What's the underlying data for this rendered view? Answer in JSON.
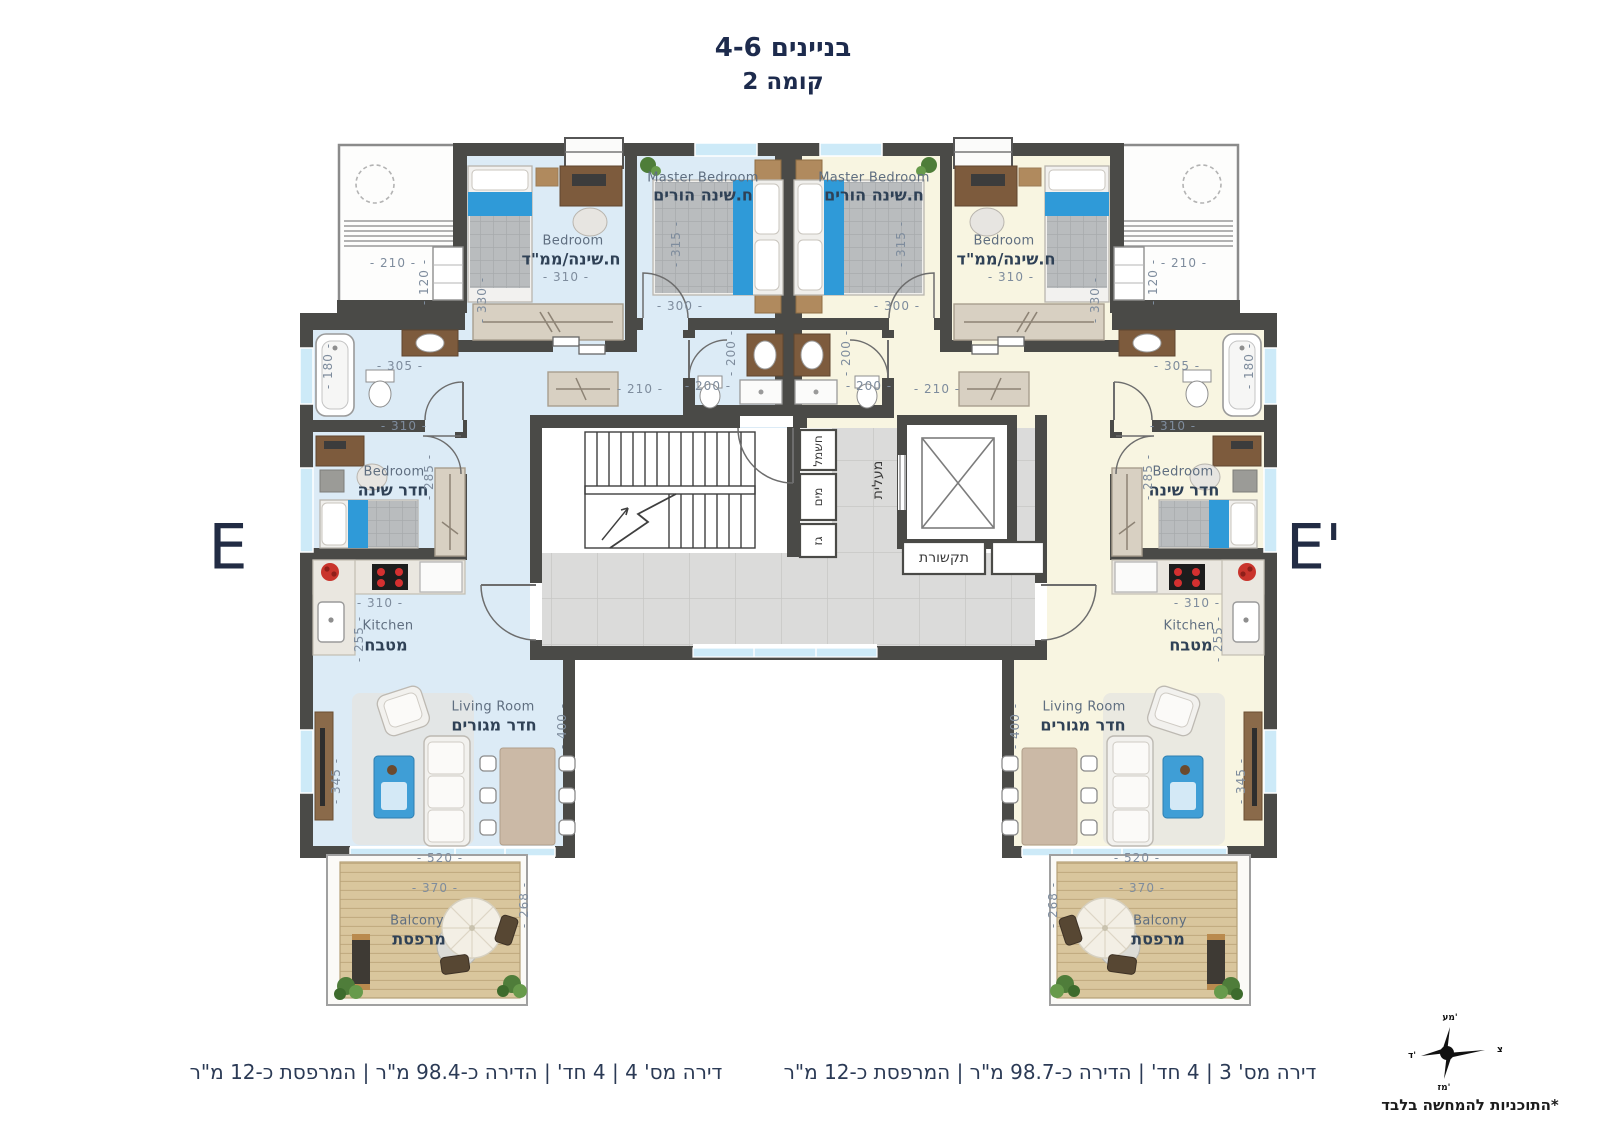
{
  "title": {
    "line1": "בניינים 4-6",
    "line2": "קומה 2"
  },
  "section_markers": {
    "left": "E",
    "right": "E'"
  },
  "rooms": {
    "master": {
      "en": "Master Bedroom",
      "he": "ח.שינה הורים"
    },
    "mamad": {
      "en": "Bedroom",
      "he": "ח.שינה/ממ\"ד"
    },
    "bedroom": {
      "en": "Bedroom",
      "he": "חדר שינה"
    },
    "kitchen": {
      "en": "Kitchen",
      "he": "מטבח"
    },
    "living": {
      "en": "Living Room",
      "he": "חדר מגורים"
    },
    "balcony": {
      "en": "Balcony",
      "he": "מרפסת"
    }
  },
  "core": {
    "elevator": "מעלית",
    "electricity": "חשמל",
    "water": "מים",
    "gas": "גז",
    "communications": "תקשורת"
  },
  "dims": {
    "d120": "- 120 -",
    "d180": "- 180 -",
    "d200": "- 200 -",
    "d210": "- 210 -",
    "d255": "- 255 -",
    "d268": "- 268 -",
    "d285": "- 285 -",
    "d300": "- 300 -",
    "d305": "- 305 -",
    "d310": "- 310 -",
    "d315": "- 315 -",
    "d330": "- 330 -",
    "d345": "- 345 -",
    "d370": "- 370 -",
    "d400": "- 400 -",
    "d520": "- 520 -"
  },
  "footer": {
    "left_apartment": "דירה מס' 4 | 4 חד' | הדירה כ-98.4 מ\"ר | המרפסת כ-12 מ\"ר",
    "right_apartment": "דירה מס' 3 | 4 חד' | הדירה כ-98.7 מ\"ר | המרפסת כ-12 מ\"ר",
    "disclaimer": "*התוכניות להמחשה בלבד"
  },
  "compass": {
    "right": "צ",
    "top": "מע'",
    "bottom": "מז'",
    "left": "ד'"
  },
  "colors": {
    "accent_blue": "#2f9ad8",
    "floor_left": "#dcebf6",
    "floor_right": "#f8f5e1",
    "wall": "#4a4a47",
    "navy": "#24324e"
  }
}
